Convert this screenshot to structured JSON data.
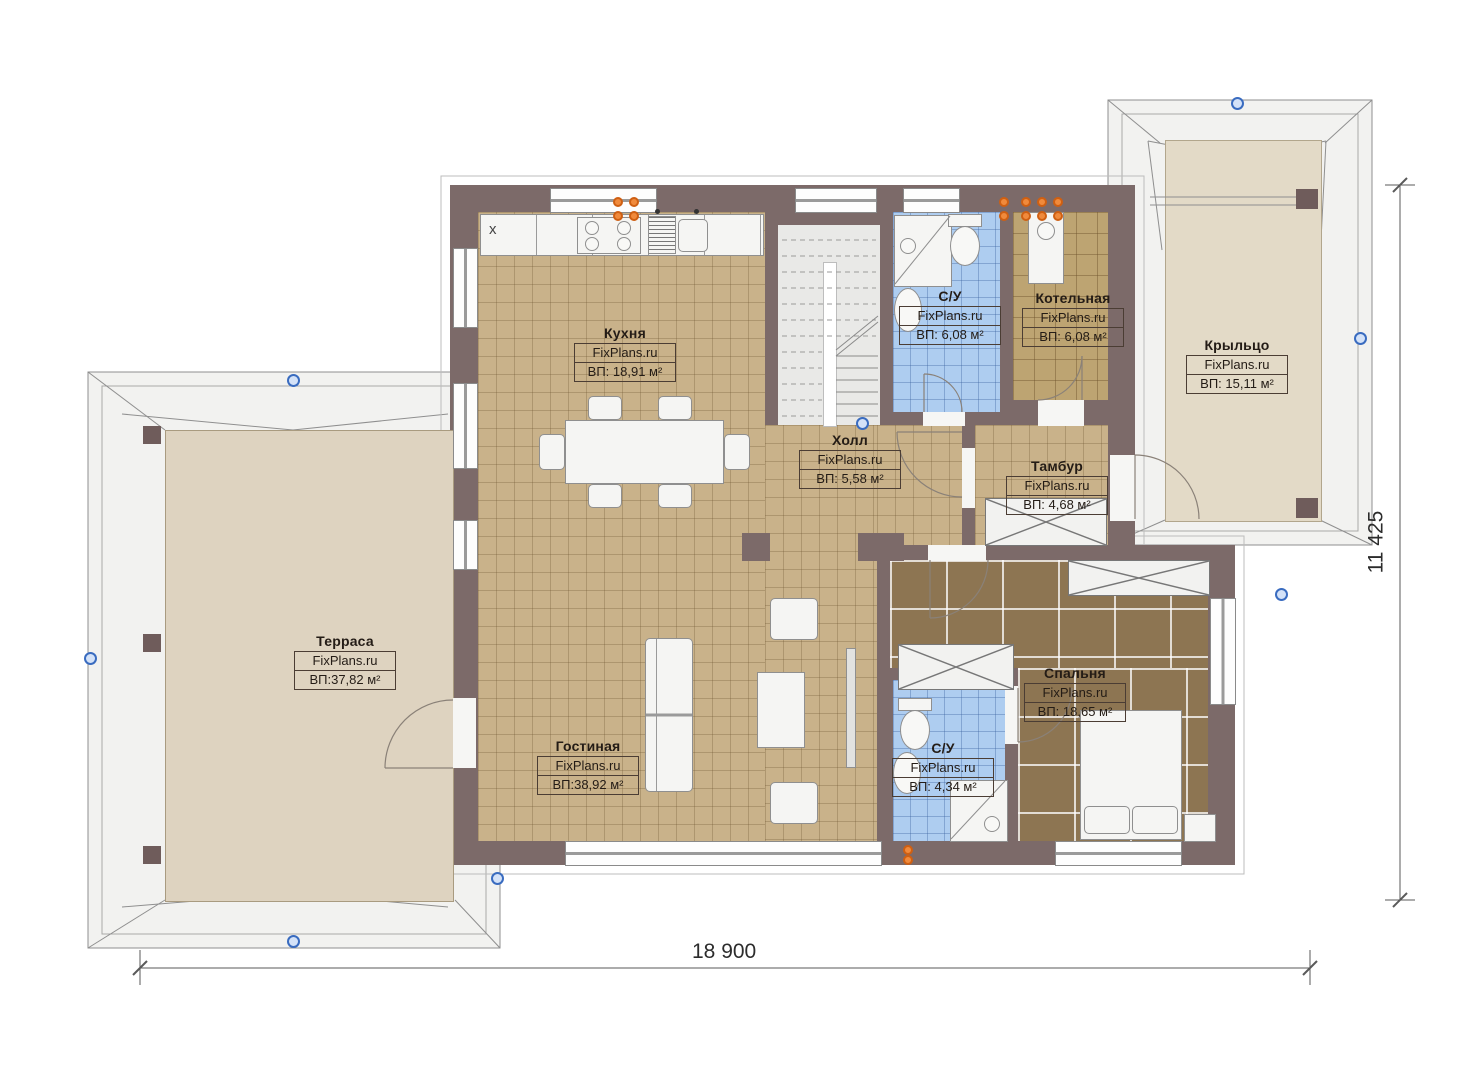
{
  "meta": {
    "brand": "FixPlans.ru",
    "drawing_type": "floor-plan"
  },
  "rooms": [
    {
      "id": "kitchen",
      "name": "Кухня",
      "area": "ВП: 18,91 м²"
    },
    {
      "id": "bathroom-top",
      "name": "С/У",
      "area": "ВП: 6,08 м²"
    },
    {
      "id": "boiler-room",
      "name": "Котельная",
      "area": "ВП: 6,08 м²"
    },
    {
      "id": "porch",
      "name": "Крыльцо",
      "area": "ВП: 15,11 м²"
    },
    {
      "id": "hall",
      "name": "Холл",
      "area": "ВП: 5,58 м²"
    },
    {
      "id": "vestibule",
      "name": "Тамбур",
      "area": "ВП: 4,68 м²"
    },
    {
      "id": "terrace",
      "name": "Терраса",
      "area": "ВП:37,82 м²"
    },
    {
      "id": "living-room",
      "name": "Гостиная",
      "area": "ВП:38,92 м²"
    },
    {
      "id": "bathroom-bottom",
      "name": "С/У",
      "area": "ВП: 4,34 м²"
    },
    {
      "id": "bedroom",
      "name": "Спальня",
      "area": "ВП: 18,65 м²"
    }
  ],
  "dimensions": {
    "overall_width": "18 900",
    "overall_height": "11 425"
  },
  "symbols": {
    "corner_cabinet_mark": "x"
  },
  "colors": {
    "wall": "#7c6a69",
    "tile_floor": "#c9b28a",
    "bath_floor": "#aecdf0",
    "boiler_floor": "#bda472",
    "bedroom_floor": "#8d7552",
    "terrace_floor": "#ded3c0",
    "porch_floor": "#e3dac7",
    "axis_marker": "#3a6cc0",
    "riser_symbol": "#f08a3c"
  }
}
